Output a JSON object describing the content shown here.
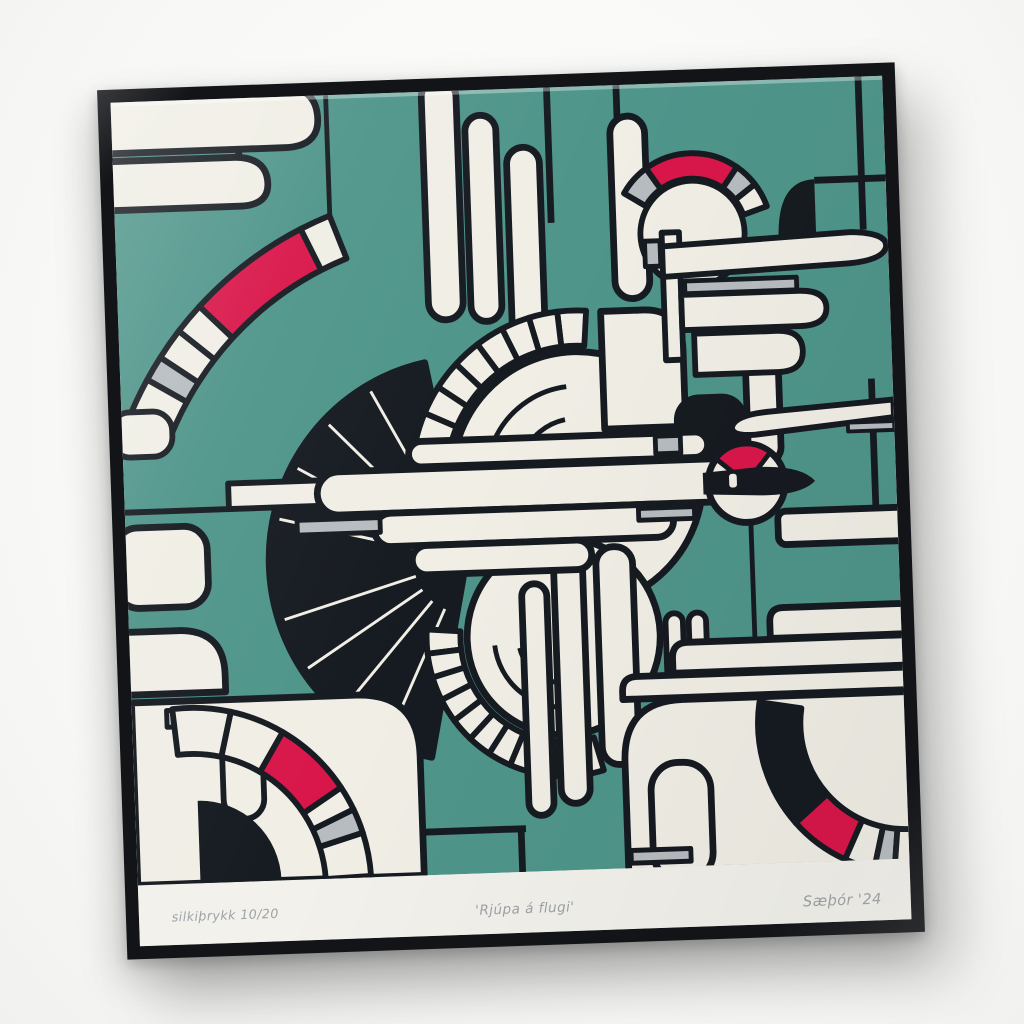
{
  "inscriptions": {
    "edition": "silkiþrykk 10/20",
    "title": "'Rjúpa á flugi'",
    "signature": "Sæþór '24"
  },
  "colors": {
    "wall": "#f7f7f5",
    "frame": "#121418",
    "margin": "#f2f1eb",
    "teal": "#4f958a",
    "cream": "#f0eee5",
    "ink": "#161b21",
    "red": "#d9164a",
    "grey": "#b7bcc0",
    "pencil": "#9da2a6"
  }
}
